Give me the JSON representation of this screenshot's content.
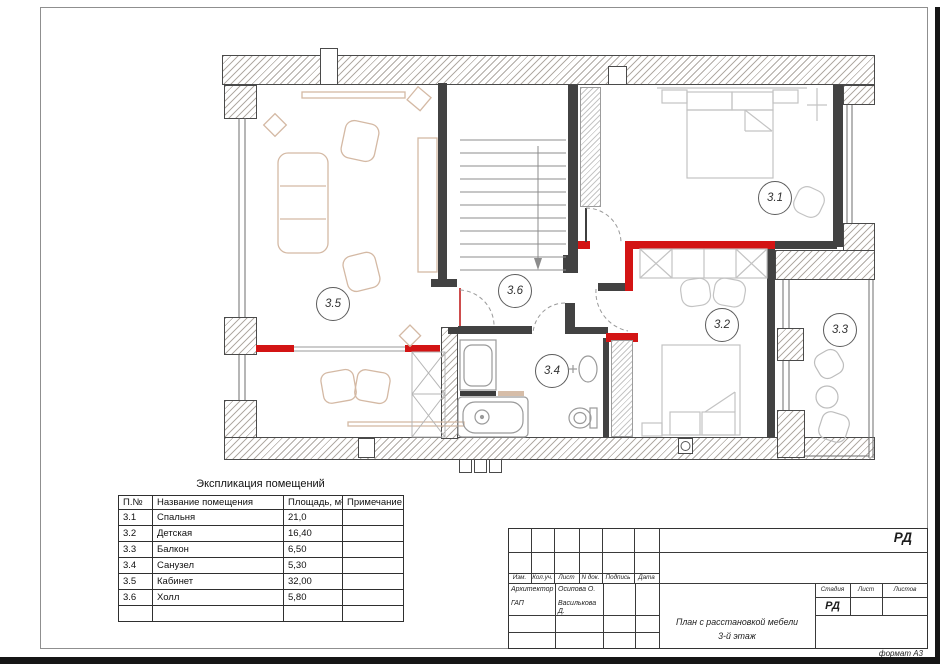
{
  "plan": {
    "labels": {
      "bedroom": "3.1",
      "nursery": "3.2",
      "balcony": "3.3",
      "bathroom": "3.4",
      "office": "3.5",
      "hall": "3.6"
    }
  },
  "explication": {
    "title": "Экспликация помещений",
    "headers": [
      "П.№",
      "Название помещения",
      "Площадь, м²",
      "Примечание"
    ],
    "rows": [
      [
        "3.1",
        "Спальня",
        "21,0",
        ""
      ],
      [
        "3.2",
        "Детская",
        "16,40",
        ""
      ],
      [
        "3.3",
        "Балкон",
        "6,50",
        ""
      ],
      [
        "3.4",
        "Санузел",
        "5,30",
        ""
      ],
      [
        "3.5",
        "Кабинет",
        "32,00",
        ""
      ],
      [
        "3.6",
        "Холл",
        "5,80",
        ""
      ],
      [
        "",
        "",
        "",
        ""
      ]
    ]
  },
  "title_block": {
    "doc_code": "РД",
    "columns": [
      "Изм.",
      "Кол.уч.",
      "Лист",
      "N док.",
      "Подпись",
      "Дата"
    ],
    "signatures": [
      {
        "role": "Архитектор",
        "name": "Осипова О."
      },
      {
        "role": "ГАП",
        "name": "Василькова Д."
      }
    ],
    "drawing_title_line1": "План с расстановкой мебели",
    "drawing_title_line2": "3-й этаж",
    "stage_header": [
      "Стадия",
      "Лист",
      "Листов"
    ],
    "stage_value": "РД",
    "format_note": "формат А3"
  }
}
